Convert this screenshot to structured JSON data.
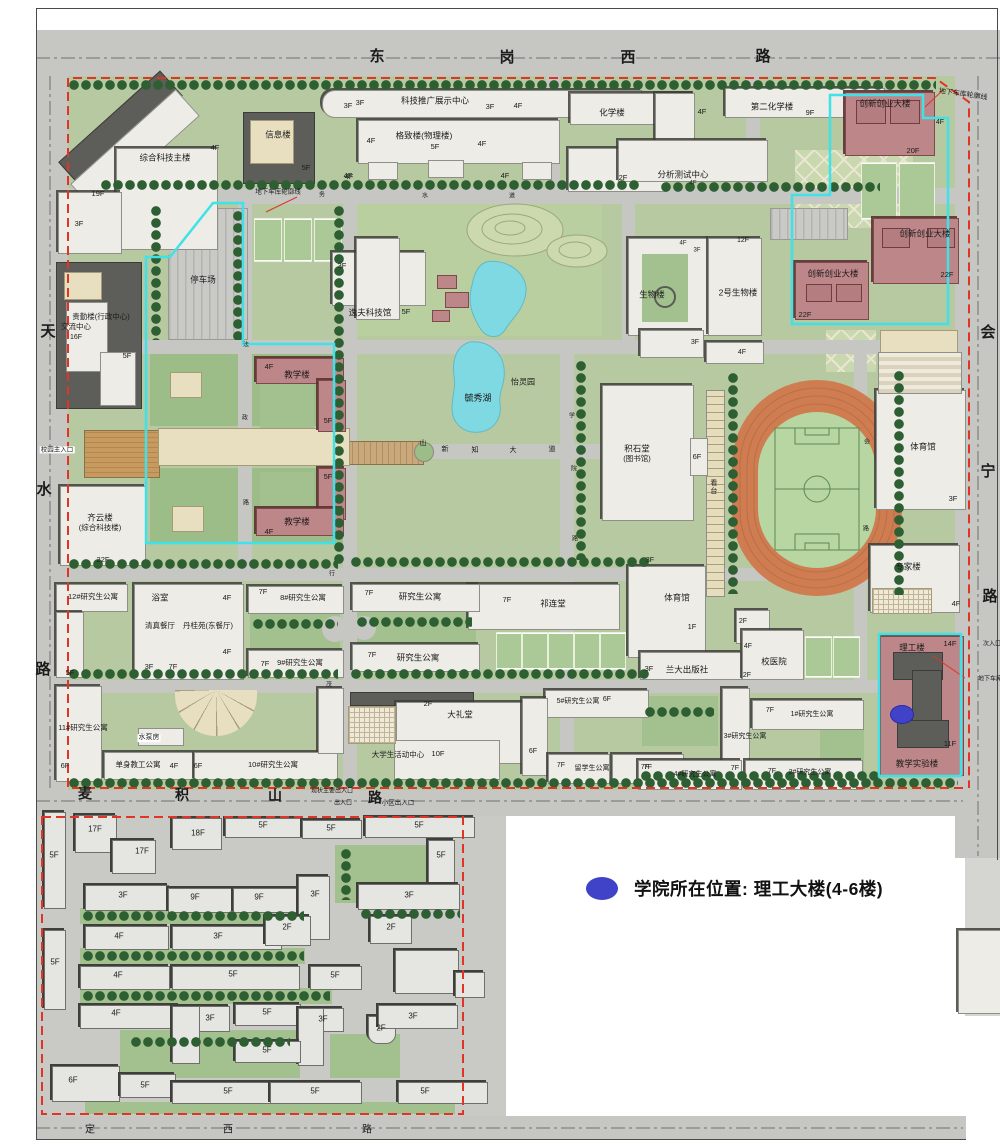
{
  "legend": {
    "marker_color": "#4043c8",
    "text": "学院所在位置: 理工大楼(4-6楼)"
  },
  "roads": {
    "north": "东岗西路",
    "west": "天水路",
    "east": "会宁路",
    "south": "麦积山路",
    "south_outer": "定西路",
    "central_avenue": "新知大道"
  },
  "map": {
    "labels": [
      {
        "n": "road-north-char",
        "t": "东",
        "x": 377,
        "y": 57,
        "s": 15,
        "b": true
      },
      {
        "n": "road-north-char",
        "t": "岗",
        "x": 507,
        "y": 58,
        "s": 15,
        "b": true
      },
      {
        "n": "road-north-char",
        "t": "西",
        "x": 628,
        "y": 58,
        "s": 15,
        "b": true
      },
      {
        "n": "road-north-char",
        "t": "路",
        "x": 763,
        "y": 57,
        "s": 15,
        "b": true
      },
      {
        "n": "road-west-char",
        "t": "天",
        "x": 48,
        "y": 332,
        "s": 15,
        "b": true
      },
      {
        "n": "road-west-char",
        "t": "水",
        "x": 44,
        "y": 490,
        "s": 15,
        "b": true
      },
      {
        "n": "road-west-char",
        "t": "路",
        "x": 43,
        "y": 670,
        "s": 15,
        "b": true
      },
      {
        "n": "road-east-char",
        "t": "会",
        "x": 988,
        "y": 333,
        "s": 15,
        "b": true
      },
      {
        "n": "road-east-char",
        "t": "宁",
        "x": 988,
        "y": 472,
        "s": 15,
        "b": true
      },
      {
        "n": "road-east-char",
        "t": "路",
        "x": 990,
        "y": 597,
        "s": 15,
        "b": true
      },
      {
        "n": "road-south-char",
        "t": "麦",
        "x": 85,
        "y": 794,
        "s": 14,
        "b": true
      },
      {
        "n": "road-south-char",
        "t": "积",
        "x": 182,
        "y": 795,
        "s": 14,
        "b": true
      },
      {
        "n": "road-south-char",
        "t": "山",
        "x": 275,
        "y": 796,
        "s": 14,
        "b": true
      },
      {
        "n": "road-south-char",
        "t": "路",
        "x": 375,
        "y": 798,
        "s": 14,
        "b": true
      },
      {
        "n": "road-outer-char",
        "t": "定",
        "x": 90,
        "y": 1130,
        "s": 10
      },
      {
        "n": "road-outer-char",
        "t": "西",
        "x": 228,
        "y": 1130,
        "s": 10
      },
      {
        "n": "road-outer-char",
        "t": "路",
        "x": 367,
        "y": 1130,
        "s": 10
      },
      {
        "t": "综合科技主楼",
        "x": 165,
        "y": 158
      },
      {
        "t": "19F",
        "x": 98,
        "y": 194,
        "s": 7.5
      },
      {
        "t": "3F",
        "x": 79,
        "y": 224,
        "s": 7.5
      },
      {
        "t": "4F",
        "x": 215,
        "y": 148,
        "s": 7.5
      },
      {
        "t": "信息楼",
        "x": 278,
        "y": 135
      },
      {
        "t": "5F",
        "x": 306,
        "y": 168,
        "s": 7.5
      },
      {
        "t": "4F",
        "x": 349,
        "y": 177,
        "s": 7.5
      },
      {
        "t": "3F",
        "x": 360,
        "y": 103,
        "s": 7.5
      },
      {
        "t": "科技推广展示中心",
        "x": 435,
        "y": 101
      },
      {
        "t": "3F",
        "x": 348,
        "y": 106,
        "s": 7.5
      },
      {
        "t": "3F",
        "x": 490,
        "y": 107,
        "s": 7.5
      },
      {
        "t": "4F",
        "x": 518,
        "y": 106,
        "s": 7.5
      },
      {
        "t": "格致楼(物理楼)",
        "x": 424,
        "y": 136
      },
      {
        "t": "4F",
        "x": 371,
        "y": 141,
        "s": 7.5
      },
      {
        "t": "5F",
        "x": 435,
        "y": 147,
        "s": 7.5
      },
      {
        "t": "4F",
        "x": 482,
        "y": 144,
        "s": 7.5
      },
      {
        "t": "4F",
        "x": 348,
        "y": 176,
        "s": 7.5
      },
      {
        "t": "4F",
        "x": 505,
        "y": 176,
        "s": 7.5
      },
      {
        "t": "化学楼",
        "x": 612,
        "y": 113
      },
      {
        "t": "4F",
        "x": 702,
        "y": 112,
        "s": 7.5
      },
      {
        "t": "2F",
        "x": 623,
        "y": 178,
        "s": 7.5
      },
      {
        "t": "第二化学楼",
        "x": 772,
        "y": 107
      },
      {
        "t": "9F",
        "x": 810,
        "y": 113,
        "s": 7.5
      },
      {
        "t": "分析测试中心",
        "x": 683,
        "y": 175
      },
      {
        "t": "4F",
        "x": 693,
        "y": 184,
        "s": 6
      },
      {
        "t": "创新创业大楼",
        "x": 885,
        "y": 104
      },
      {
        "t": "4F",
        "x": 940,
        "y": 123,
        "s": 7
      },
      {
        "t": "20F",
        "x": 913,
        "y": 151,
        "s": 7.5
      },
      {
        "t": "创新创业大楼",
        "x": 925,
        "y": 234
      },
      {
        "t": "22F",
        "x": 947,
        "y": 275,
        "s": 7.5
      },
      {
        "t": "创新创业大楼",
        "x": 833,
        "y": 274
      },
      {
        "t": "22F",
        "x": 805,
        "y": 315,
        "s": 7.5
      },
      {
        "n": "garage-outline-label",
        "t": "地下车库轮廓线",
        "x": 963,
        "y": 95,
        "s": 7,
        "r": 8
      },
      {
        "n": "garage-outline-label",
        "t": "地下车库轮廓线",
        "x": 278,
        "y": 192,
        "s": 6.5
      },
      {
        "t": "停车场",
        "x": 203,
        "y": 280
      },
      {
        "t": "3F",
        "x": 342,
        "y": 266,
        "s": 7.5
      },
      {
        "t": "逸夫科技馆",
        "x": 370,
        "y": 313
      },
      {
        "t": "5F",
        "x": 406,
        "y": 312,
        "s": 7.5
      },
      {
        "t": "贵勤楼(行政中心)",
        "x": 101,
        "y": 317,
        "s": 7.5
      },
      {
        "t": "交流中心",
        "x": 76,
        "y": 327,
        "s": 7.5
      },
      {
        "t": "16F",
        "x": 76,
        "y": 338,
        "s": 7
      },
      {
        "t": "5F",
        "x": 127,
        "y": 356,
        "s": 7.5
      },
      {
        "n": "main-entrance-label",
        "t": "校园主入口",
        "x": 57,
        "y": 450,
        "s": 6.5,
        "bg": "#ffffff"
      },
      {
        "t": "齐云楼",
        "x": 100,
        "y": 518
      },
      {
        "t": "(综合科技楼)",
        "x": 100,
        "y": 528,
        "s": 7.5
      },
      {
        "t": "22F",
        "x": 103,
        "y": 560,
        "s": 7.5
      },
      {
        "t": "教学楼",
        "x": 297,
        "y": 375
      },
      {
        "t": "4F",
        "x": 269,
        "y": 367,
        "s": 7.5
      },
      {
        "t": "5F",
        "x": 328,
        "y": 421,
        "s": 7.5
      },
      {
        "t": "教学楼",
        "x": 297,
        "y": 522
      },
      {
        "t": "5F",
        "x": 328,
        "y": 477,
        "s": 7.5
      },
      {
        "t": "4F",
        "x": 269,
        "y": 532,
        "s": 7.5
      },
      {
        "n": "lake-label",
        "t": "毓秀湖",
        "x": 478,
        "y": 399,
        "s": 9
      },
      {
        "t": "怡灵园",
        "x": 523,
        "y": 383,
        "s": 8
      },
      {
        "t": "生物楼",
        "x": 652,
        "y": 295
      },
      {
        "t": "4F",
        "x": 683,
        "y": 244,
        "s": 6
      },
      {
        "t": "3F",
        "x": 697,
        "y": 251,
        "s": 6
      },
      {
        "t": "2号生物楼",
        "x": 738,
        "y": 293
      },
      {
        "t": "12F",
        "x": 743,
        "y": 241,
        "s": 7
      },
      {
        "t": "积石堂",
        "x": 637,
        "y": 449
      },
      {
        "t": "(图书馆)",
        "x": 637,
        "y": 459,
        "s": 7.5
      },
      {
        "t": "6F",
        "x": 697,
        "y": 457,
        "s": 7.5
      },
      {
        "t": "看台",
        "x": 713,
        "y": 487,
        "s": 7,
        "v": true
      },
      {
        "t": "3F",
        "x": 695,
        "y": 343,
        "s": 7
      },
      {
        "t": "4F",
        "x": 742,
        "y": 353,
        "s": 7
      },
      {
        "t": "体育馆",
        "x": 923,
        "y": 447
      },
      {
        "t": "3F",
        "x": 953,
        "y": 499,
        "s": 7.5
      },
      {
        "t": "专家楼",
        "x": 908,
        "y": 567
      },
      {
        "t": "4F",
        "x": 956,
        "y": 604,
        "s": 7.5
      },
      {
        "t": "理工楼",
        "x": 912,
        "y": 648
      },
      {
        "t": "14F",
        "x": 950,
        "y": 644,
        "s": 7.5
      },
      {
        "t": "11F",
        "x": 950,
        "y": 744,
        "s": 7.5
      },
      {
        "t": "教学实验楼",
        "x": 917,
        "y": 764
      },
      {
        "t": "体育馆",
        "x": 677,
        "y": 598
      },
      {
        "t": "3F",
        "x": 650,
        "y": 561,
        "s": 7
      },
      {
        "t": "1F",
        "x": 692,
        "y": 627,
        "s": 7.5
      },
      {
        "t": "兰大出版社",
        "x": 687,
        "y": 670
      },
      {
        "t": "3F",
        "x": 649,
        "y": 669,
        "s": 7.5
      },
      {
        "t": "校医院",
        "x": 774,
        "y": 662
      },
      {
        "t": "2F",
        "x": 743,
        "y": 622,
        "s": 7
      },
      {
        "t": "4F",
        "x": 748,
        "y": 647,
        "s": 7
      },
      {
        "t": "2F",
        "x": 747,
        "y": 676,
        "s": 7
      },
      {
        "t": "祁连堂",
        "x": 553,
        "y": 604
      },
      {
        "t": "7F",
        "x": 507,
        "y": 600,
        "s": 7.5
      },
      {
        "t": "研究生公寓",
        "x": 420,
        "y": 597
      },
      {
        "t": "7F",
        "x": 369,
        "y": 593,
        "s": 7.5
      },
      {
        "t": "研究生公寓",
        "x": 418,
        "y": 658
      },
      {
        "t": "7F",
        "x": 372,
        "y": 655,
        "s": 7.5
      },
      {
        "t": "8#研究生公寓",
        "x": 303,
        "y": 598,
        "s": 7.5
      },
      {
        "t": "7F",
        "x": 263,
        "y": 592,
        "s": 7.5
      },
      {
        "t": "9#研究生公寓",
        "x": 300,
        "y": 663,
        "s": 7.5
      },
      {
        "t": "7F",
        "x": 265,
        "y": 664,
        "s": 7.5
      },
      {
        "t": "12#研究生公寓",
        "x": 93,
        "y": 597,
        "s": 7.5
      },
      {
        "t": "5F",
        "x": 70,
        "y": 673,
        "s": 7.5
      },
      {
        "t": "浴室",
        "x": 160,
        "y": 598
      },
      {
        "t": "4F",
        "x": 227,
        "y": 598,
        "s": 7.5
      },
      {
        "t": "清真餐厅",
        "x": 160,
        "y": 626,
        "s": 7.5
      },
      {
        "t": "丹桂苑(东餐厅)",
        "x": 208,
        "y": 626,
        "s": 7.5
      },
      {
        "t": "4F",
        "x": 227,
        "y": 652,
        "s": 7.5
      },
      {
        "t": "3F",
        "x": 149,
        "y": 667,
        "s": 7.5
      },
      {
        "t": "7F",
        "x": 173,
        "y": 667,
        "s": 7.5
      },
      {
        "t": "11#研究生公寓",
        "x": 83,
        "y": 728,
        "s": 7.5
      },
      {
        "t": "6F",
        "x": 65,
        "y": 766,
        "s": 7.5
      },
      {
        "t": "水泵房",
        "x": 149,
        "y": 738,
        "s": 7,
        "bg": "#ffffff"
      },
      {
        "t": "单身教工公寓",
        "x": 138,
        "y": 765,
        "s": 7.5
      },
      {
        "t": "4F",
        "x": 174,
        "y": 766,
        "s": 7.5
      },
      {
        "t": "10#研究生公寓",
        "x": 273,
        "y": 765,
        "s": 7.5
      },
      {
        "t": "6F",
        "x": 198,
        "y": 766,
        "s": 7.5
      },
      {
        "t": "大礼堂",
        "x": 460,
        "y": 715
      },
      {
        "t": "2F",
        "x": 428,
        "y": 704,
        "s": 7.5
      },
      {
        "t": "大学生活动中心",
        "x": 398,
        "y": 755,
        "s": 7.5
      },
      {
        "t": "10F",
        "x": 438,
        "y": 754,
        "s": 7.5
      },
      {
        "t": "5#研究生公寓",
        "x": 578,
        "y": 702,
        "s": 7
      },
      {
        "t": "6F",
        "x": 607,
        "y": 700,
        "s": 7
      },
      {
        "t": "6F",
        "x": 533,
        "y": 752,
        "s": 7
      },
      {
        "t": "7F",
        "x": 561,
        "y": 766,
        "s": 7
      },
      {
        "t": "留学生公寓",
        "x": 592,
        "y": 769,
        "s": 7
      },
      {
        "t": "7F",
        "x": 645,
        "y": 768,
        "s": 7
      },
      {
        "t": "1#研究生公寓",
        "x": 812,
        "y": 715,
        "s": 7
      },
      {
        "t": "7F",
        "x": 770,
        "y": 711,
        "s": 7
      },
      {
        "t": "3#研究生公寓",
        "x": 745,
        "y": 737,
        "s": 7
      },
      {
        "t": "7F",
        "x": 735,
        "y": 769,
        "s": 7
      },
      {
        "t": "2#研究生公寓",
        "x": 810,
        "y": 773,
        "s": 7
      },
      {
        "t": "7F",
        "x": 772,
        "y": 772,
        "s": 7
      },
      {
        "t": "4#研究生公寓",
        "x": 695,
        "y": 775,
        "s": 7
      },
      {
        "t": "7F",
        "x": 648,
        "y": 768,
        "s": 7
      },
      {
        "n": "entrance-label",
        "t": "现状主要出入口",
        "x": 332,
        "y": 792,
        "s": 6
      },
      {
        "n": "entrance-label",
        "t": "出入口",
        "x": 343,
        "y": 804,
        "s": 6
      },
      {
        "n": "entrance-label",
        "t": "小区出入口",
        "x": 398,
        "y": 803,
        "s": 6.5
      },
      {
        "n": "entrance-label",
        "t": "次入口",
        "x": 992,
        "y": 645,
        "s": 6
      },
      {
        "n": "garage-outline-label",
        "t": "地下车库",
        "x": 990,
        "y": 680,
        "s": 6
      },
      {
        "n": "avenue-char",
        "t": "新",
        "x": 445,
        "y": 450,
        "s": 7
      },
      {
        "n": "avenue-char",
        "t": "知",
        "x": 475,
        "y": 451,
        "s": 7
      },
      {
        "n": "avenue-char",
        "t": "大",
        "x": 513,
        "y": 451,
        "s": 7
      },
      {
        "n": "avenue-char",
        "t": "道",
        "x": 552,
        "y": 450,
        "s": 7
      },
      {
        "n": "avenue-char",
        "t": "山",
        "x": 423,
        "y": 444,
        "s": 7
      },
      {
        "n": "inner-road-char",
        "t": "务",
        "x": 322,
        "y": 196,
        "s": 6
      },
      {
        "n": "inner-road-char",
        "t": "水",
        "x": 425,
        "y": 197,
        "s": 6
      },
      {
        "n": "inner-road-char",
        "t": "道",
        "x": 512,
        "y": 197,
        "s": 6
      },
      {
        "n": "inner-road-char",
        "t": "法",
        "x": 246,
        "y": 346,
        "s": 6
      },
      {
        "n": "inner-road-char",
        "t": "政",
        "x": 245,
        "y": 419,
        "s": 6
      },
      {
        "n": "inner-road-char",
        "t": "路",
        "x": 246,
        "y": 504,
        "s": 6
      },
      {
        "n": "inner-road-char",
        "t": "学",
        "x": 572,
        "y": 417,
        "s": 6
      },
      {
        "n": "inner-road-char",
        "t": "院",
        "x": 574,
        "y": 470,
        "s": 6
      },
      {
        "n": "inner-road-char",
        "t": "路",
        "x": 575,
        "y": 540,
        "s": 6
      },
      {
        "n": "inner-road-char",
        "t": "会",
        "x": 867,
        "y": 443,
        "s": 6
      },
      {
        "n": "inner-road-char",
        "t": "路",
        "x": 866,
        "y": 530,
        "s": 6
      },
      {
        "n": "inner-road-char",
        "t": "行",
        "x": 332,
        "y": 575,
        "s": 6
      },
      {
        "n": "inner-road-char",
        "t": "茂",
        "x": 329,
        "y": 686,
        "s": 6
      },
      {
        "t": "17F",
        "x": 95,
        "y": 830,
        "s": 8
      },
      {
        "t": "17F",
        "x": 142,
        "y": 852,
        "s": 8
      },
      {
        "t": "18F",
        "x": 198,
        "y": 834,
        "s": 8
      },
      {
        "t": "5F",
        "x": 263,
        "y": 826,
        "s": 8
      },
      {
        "t": "5F",
        "x": 331,
        "y": 829,
        "s": 8
      },
      {
        "t": "5F",
        "x": 419,
        "y": 826,
        "s": 8
      },
      {
        "t": "5F",
        "x": 54,
        "y": 856,
        "s": 8
      },
      {
        "t": "5F",
        "x": 441,
        "y": 856,
        "s": 8
      },
      {
        "t": "3F",
        "x": 123,
        "y": 896,
        "s": 8
      },
      {
        "t": "9F",
        "x": 195,
        "y": 898,
        "s": 8
      },
      {
        "t": "9F",
        "x": 259,
        "y": 898,
        "s": 8
      },
      {
        "t": "3F",
        "x": 315,
        "y": 895,
        "s": 8
      },
      {
        "t": "3F",
        "x": 409,
        "y": 896,
        "s": 8
      },
      {
        "t": "4F",
        "x": 119,
        "y": 937,
        "s": 8
      },
      {
        "t": "3F",
        "x": 218,
        "y": 937,
        "s": 8
      },
      {
        "t": "2F",
        "x": 287,
        "y": 928,
        "s": 8
      },
      {
        "t": "2F",
        "x": 391,
        "y": 928,
        "s": 8
      },
      {
        "t": "5F",
        "x": 55,
        "y": 963,
        "s": 8
      },
      {
        "t": "4F",
        "x": 118,
        "y": 976,
        "s": 8
      },
      {
        "t": "5F",
        "x": 233,
        "y": 975,
        "s": 8
      },
      {
        "t": "5F",
        "x": 335,
        "y": 976,
        "s": 8
      },
      {
        "t": "4F",
        "x": 116,
        "y": 1014,
        "s": 8
      },
      {
        "t": "3F",
        "x": 210,
        "y": 1019,
        "s": 8
      },
      {
        "t": "5F",
        "x": 267,
        "y": 1013,
        "s": 8
      },
      {
        "t": "3F",
        "x": 323,
        "y": 1020,
        "s": 8
      },
      {
        "t": "2F",
        "x": 381,
        "y": 1029,
        "s": 8
      },
      {
        "t": "3F",
        "x": 413,
        "y": 1017,
        "s": 8
      },
      {
        "t": "5F",
        "x": 267,
        "y": 1051,
        "s": 8
      },
      {
        "t": "6F",
        "x": 73,
        "y": 1081,
        "s": 8
      },
      {
        "t": "5F",
        "x": 145,
        "y": 1086,
        "s": 8
      },
      {
        "t": "5F",
        "x": 228,
        "y": 1092,
        "s": 8
      },
      {
        "t": "5F",
        "x": 315,
        "y": 1092,
        "s": 8
      },
      {
        "t": "5F",
        "x": 425,
        "y": 1092,
        "s": 8
      }
    ]
  }
}
